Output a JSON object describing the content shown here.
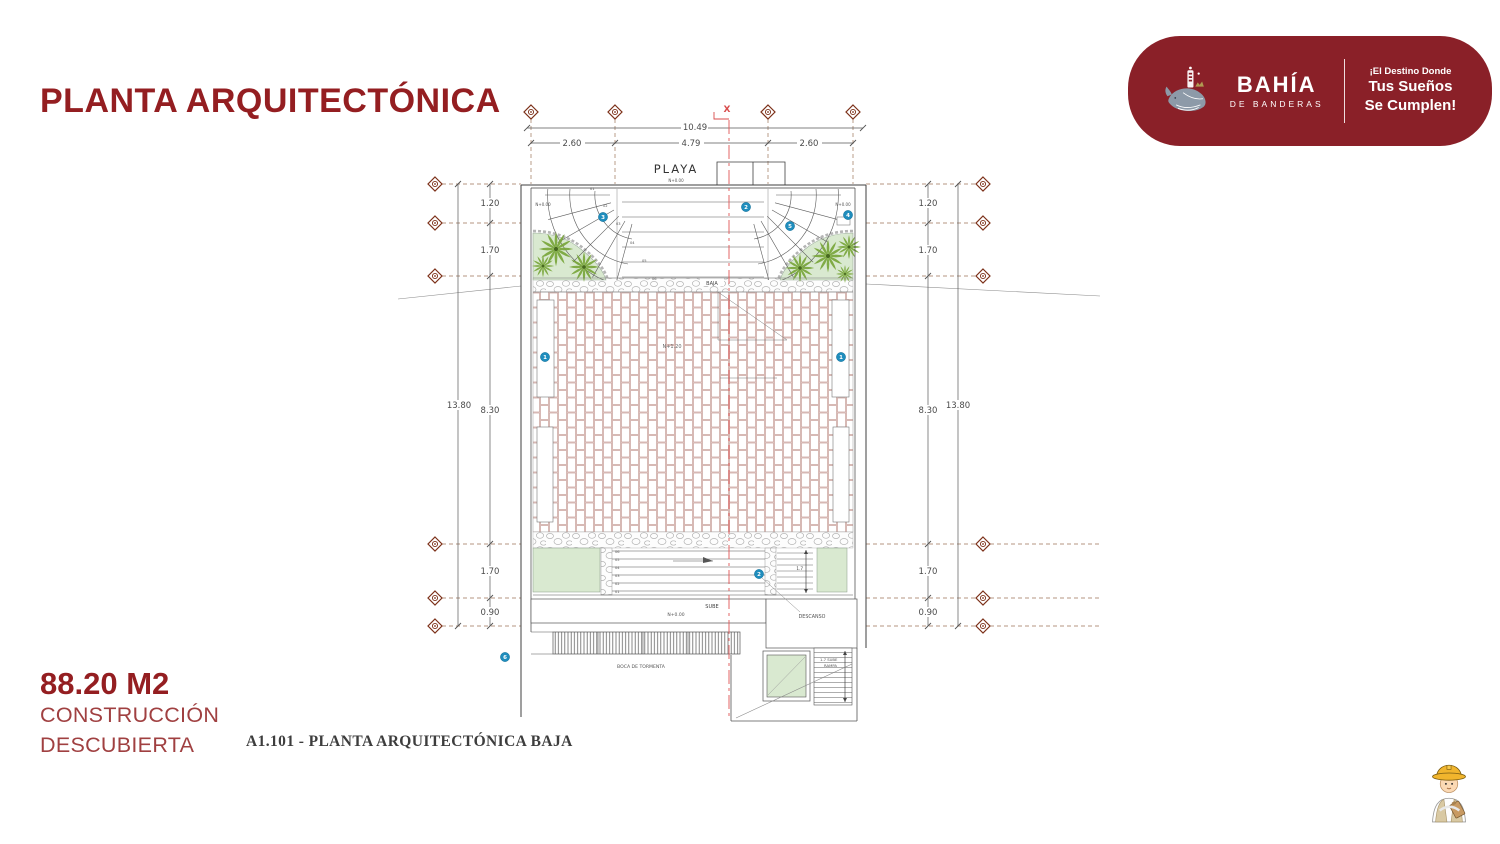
{
  "slide": {
    "title": "PLANTA ARQUITECTÓNICA"
  },
  "badge": {
    "brand": "BAHÍA",
    "brand_sub": "DE BANDERAS",
    "tagline_1": "¡El Destino Donde",
    "tagline_2": "Tus Sueños",
    "tagline_3": "Se Cumplen!"
  },
  "area": {
    "value": "88.20 M2",
    "line1": "CONSTRUCCIÓN",
    "line2": "DESCUBIERTA"
  },
  "caption": "A1.101 - PLANTA ARQUITECTÓNICA BAJA",
  "plan": {
    "axis_label": "X",
    "dims": {
      "top_total": "10.49",
      "top_left": "2.60",
      "top_center": "4.79",
      "top_right": "2.60",
      "left_total": "13.80",
      "right_total": "13.80",
      "row1": "1.20",
      "row2": "1.70",
      "row3": "8.30",
      "row4": "1.70",
      "row5": "0.90",
      "stair_run": "1.7"
    },
    "labels": {
      "playa": "PLAYA",
      "level_zero": "N+0.00",
      "level_court": "N+1.20",
      "baja": "BAJA",
      "sube": "SUBE",
      "descanso": "DESCANSO",
      "boca_tormenta": "BOCA DE TORMENTA",
      "ramp_line1": "1.7 SUBE",
      "ramp_line2": "RAMPA"
    },
    "steps_top": [
      "01",
      "02",
      "03",
      "04",
      "05",
      "06"
    ],
    "steps_bottom": [
      "06",
      "05",
      "04",
      "03",
      "02",
      "01"
    ],
    "markers": {
      "m1": "1",
      "m2": "2",
      "m3": "3",
      "m4": "4",
      "m5": "5",
      "m6": "6"
    }
  },
  "colors": {
    "maroon": "#941E21",
    "badge_bg": "#8A2028",
    "marker_blue": "#1F8DBD",
    "planter_green": "#D9E9D0",
    "palm_green": "#79A63B",
    "brick_line": "#C79D97",
    "centerline_red": "#E05555",
    "axis_brown": "#7C3018"
  }
}
